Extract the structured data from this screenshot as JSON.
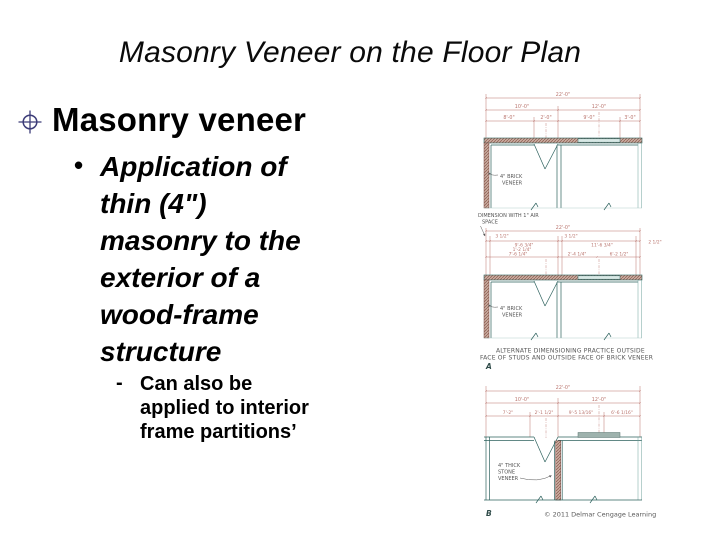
{
  "slide": {
    "title": "Masonry Veneer on the Floor Plan",
    "bullets": {
      "level1": "Masonry veneer",
      "level2_marker": "•",
      "level2_lines": [
        "Application of",
        "thin (4\")",
        "masonry to the",
        "exterior of a",
        "wood-frame",
        "structure"
      ],
      "level3_marker": "-",
      "level3_lines": [
        "Can also be",
        "applied to interior",
        "frame partitions’"
      ]
    }
  },
  "figure": {
    "top": {
      "dim_overall": "22'-0\"",
      "dim_row2": [
        "10'-0\"",
        "12'-0\""
      ],
      "dim_row3": [
        "8'-0\"",
        "2'-0\"",
        "9'-0\"",
        "3'-0\""
      ],
      "veneer": [
        "4\" BRICK",
        "VENEER"
      ]
    },
    "middle": {
      "note": [
        "DIMENSION WITH 1\" AIR",
        "SPACE"
      ],
      "dim_overall": "22'-0\"",
      "dim_row2": [
        "3 1/2\"",
        "9'-6 3/4\"",
        "3 1/2\"",
        "11'-6 3/4\"",
        "2 1/2\""
      ],
      "dim_row3": [
        "1'-2 1/4\"",
        "7'-6 1/4\"",
        "2'-4 1/4\"",
        "6'-2 1/2\""
      ],
      "veneer": [
        "4\" BRICK",
        "VENEER"
      ],
      "caption": [
        "ALTERNATE DIMENSIONING PRACTICE OUTSIDE",
        "FACE OF STUDS AND OUTSIDE FACE OF BRICK VENEER"
      ],
      "label": "A"
    },
    "bottom": {
      "dim_overall": "22'-0\"",
      "dim_row2": [
        "10'-0\"",
        "12'-0\""
      ],
      "dim_row3": [
        "7'-2\"",
        "2'-1 1/2\"",
        "9'-5 13/16\"",
        "6'-6 1/16\""
      ],
      "veneer": [
        "4\" THICK",
        "STONE",
        "VENEER"
      ],
      "label": "B",
      "copyright": "© 2011 Delmar Cengage Learning"
    },
    "colors": {
      "dimension": "#b9736c",
      "wall": "#2e625e",
      "brick": "#8a5a4e",
      "annotation": "#555555",
      "bullet_icon": "#3c3c78"
    }
  }
}
